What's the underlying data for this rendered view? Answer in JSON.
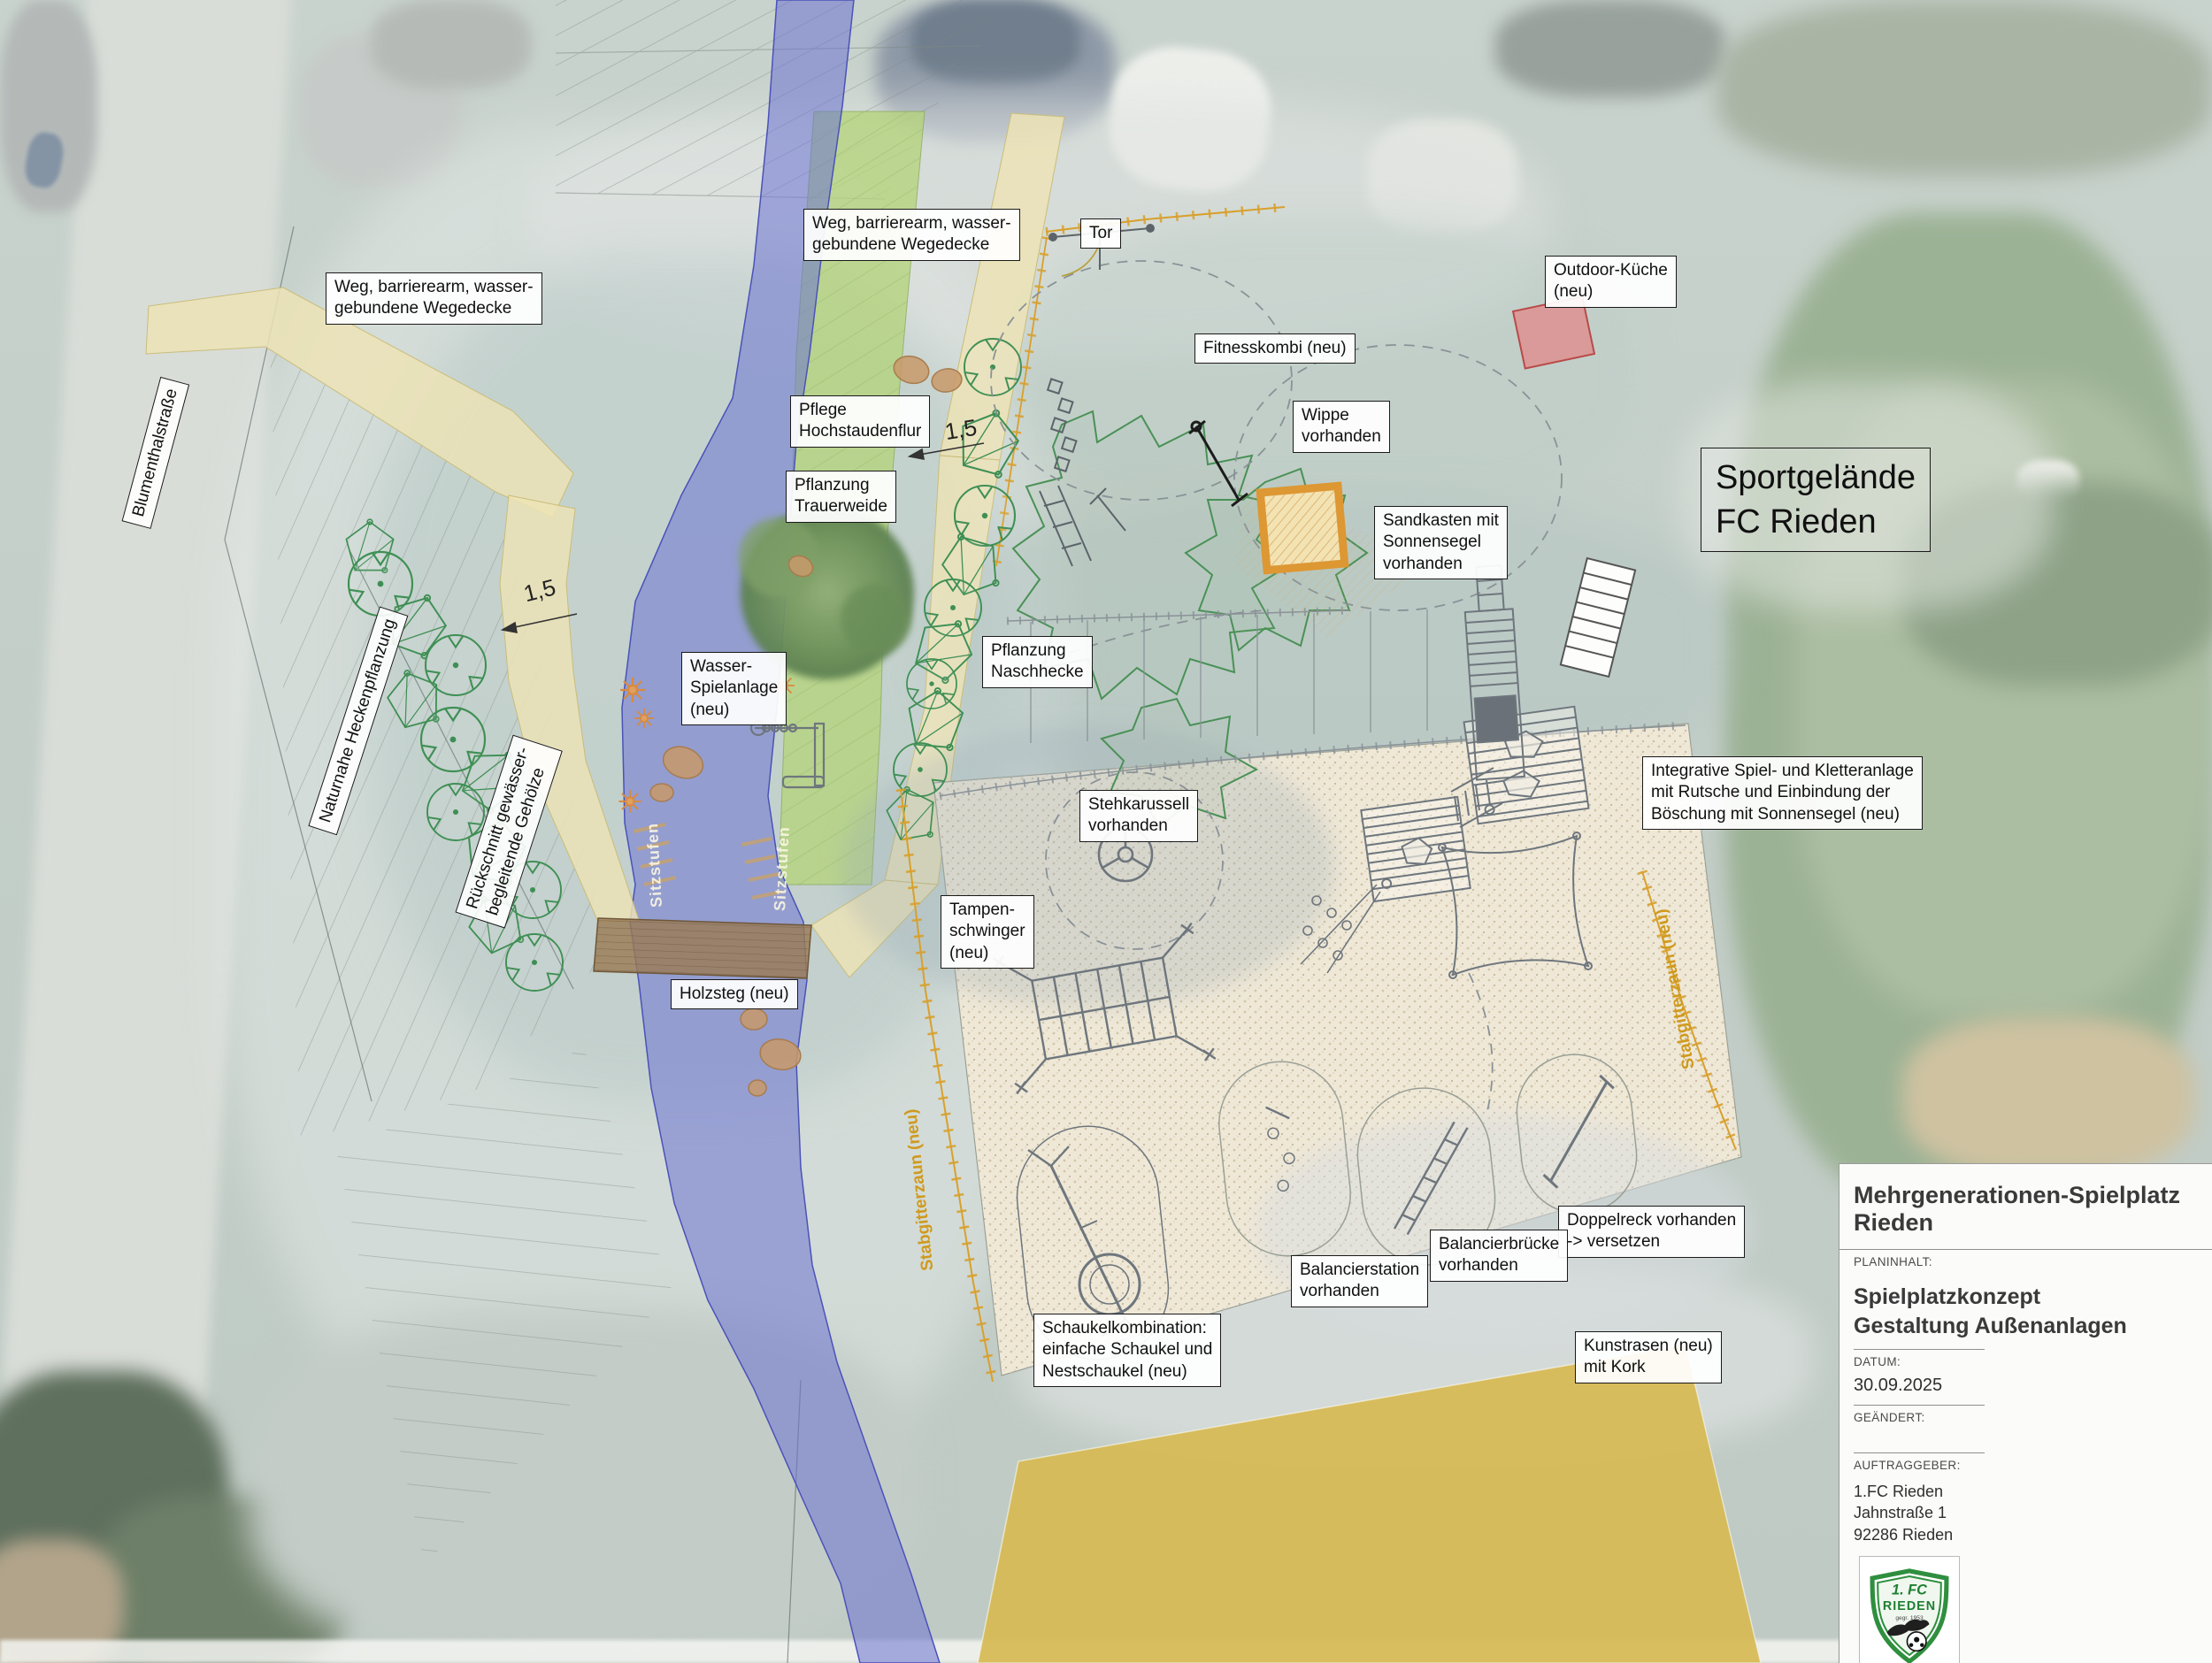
{
  "labels": {
    "weg_barrierearm": "Weg, barrierearm, wasser-\ngebundene Wegedecke",
    "blumenthalstrasse": "Blumenthalstraße",
    "tor": "Tor",
    "outdoor_kueche": "Outdoor-Küche\n(neu)",
    "fitnesskombi": "Fitnesskombi (neu)",
    "wippe": "Wippe\nvorhanden",
    "sandkasten": "Sandkasten mit\nSonnensegel\nvorhanden",
    "sportgelaende": "Sportgelände\nFC Rieden",
    "pflege_hochstaudenflur": "Pflege\nHochstaudenflur",
    "pflanzung_trauerweide": "Pflanzung\nTrauerweide",
    "pflanzung_naschhecke": "Pflanzung\nNaschhecke",
    "wasser_spielanlage": "Wasser-\nSpielanlage\n(neu)",
    "naturnahe_heckenpflanzung": "Naturnahe Heckenpflanzung",
    "rueckschnitt_gehoelze": "Rückschnitt gewässer-\nbegleitende Gehölze",
    "holzsteg": "Holzsteg (neu)",
    "stehkarussell": "Stehkarussell\nvorhanden",
    "tampenschwinger": "Tampen-\nschwinger\n(neu)",
    "integrative_anlage": "Integrative Spiel- und Kletteranlage\nmit Rutsche und Einbindung der\nBöschung mit Sonnensegel (neu)",
    "doppelreck": "Doppelreck vorhanden\n-> versetzen",
    "balancierbruecke": "Balancierbrücke\nvorhanden",
    "balancierstation": "Balancierstation\nvorhanden",
    "schaukelkombination": "Schaukelkombination:\neinfache Schaukel und\nNestschaukel (neu)",
    "kunstrasen": "Kunstrasen (neu)\nmit Kork",
    "sitzstufen": "Sitzstufen",
    "stabgitterzaun": "Stabgitterzaun (neu)",
    "dim_15": "1,5"
  },
  "titleblock": {
    "project_title": "Mehrgenerationen-Spielplatz Rieden",
    "planinhalt_label": "PLANINHALT:",
    "planinhalt_line1": "Spielplatzkonzept",
    "planinhalt_line2": "Gestaltung Außenanlagen",
    "datum_label": "DATUM:",
    "datum_value": "30.09.2025",
    "geaendert_label": "GEÄNDERT:",
    "auftraggeber_label": "AUFTRAGGEBER:",
    "client_name": "1.FC Rieden",
    "client_street": "Jahnstraße 1",
    "client_city": "92286 Rieden",
    "logo": {
      "top": "1. FC",
      "name": "RIEDEN",
      "founded": "gegr. 1953"
    }
  },
  "colors": {
    "river": "#6c73d2",
    "path": "#ece3b6",
    "meadow": "#b5d47c",
    "sand": "#efe8d7",
    "turf": "#d7ba52",
    "fence": "#d8a02c",
    "sandbox": "#dd9733",
    "kitchen-fill": "#dd9090",
    "kitchen-border": "#b94a48",
    "tree": "#3f8f54",
    "equipment": "#6e767d",
    "label-border": "#1a1a1a"
  }
}
